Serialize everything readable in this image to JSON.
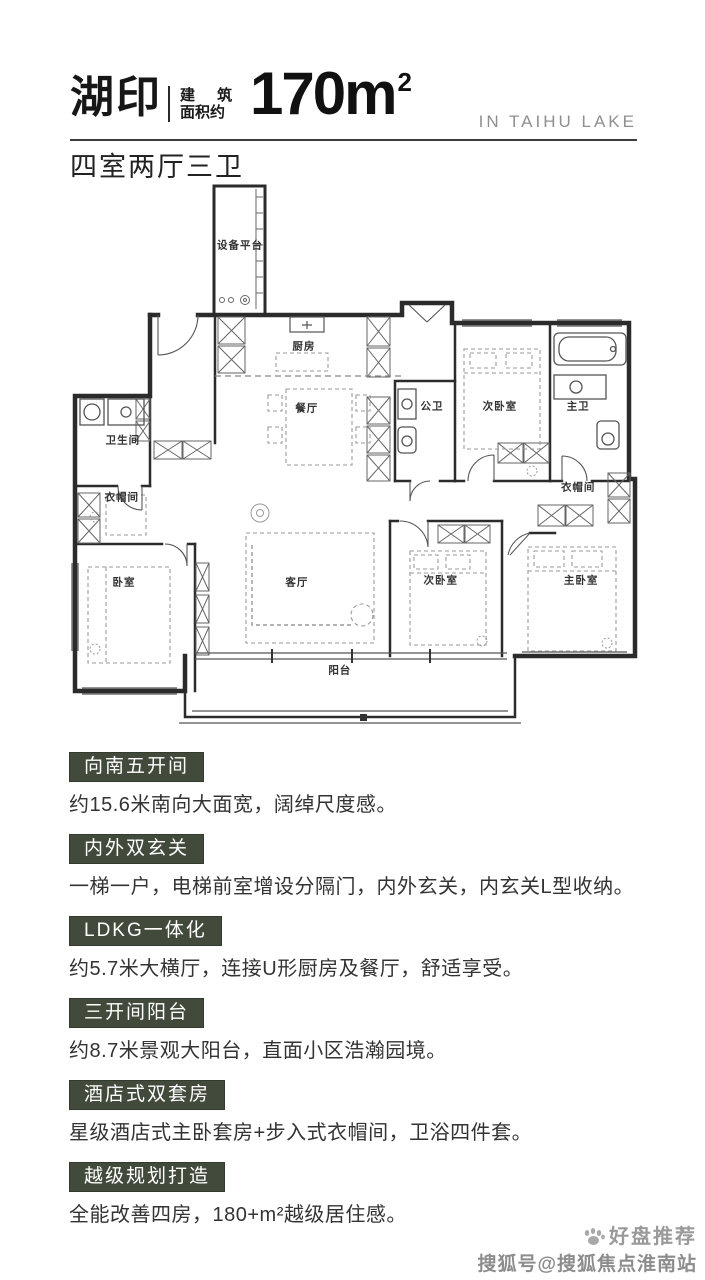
{
  "header": {
    "project_name": "湖印",
    "area_prefix_line1": "建 筑",
    "area_prefix_line2": "面积约",
    "area_value": "170m",
    "area_superscript": "2",
    "tagline_en": "IN TAIHU LAKE",
    "layout_summary": "四室两厅三卫"
  },
  "floor_plan": {
    "rooms": [
      {
        "name": "设备平台"
      },
      {
        "name": "厨房"
      },
      {
        "name": "餐厅"
      },
      {
        "name": "公卫"
      },
      {
        "name": "次卧室"
      },
      {
        "name": "主卫"
      },
      {
        "name": "卫生间"
      },
      {
        "name": "衣帽间"
      },
      {
        "name": "卧室"
      },
      {
        "name": "客厅"
      },
      {
        "name": "次卧室"
      },
      {
        "name": "主卧室"
      },
      {
        "name": "衣帽间"
      },
      {
        "name": "阳台"
      }
    ]
  },
  "features": [
    {
      "title": "向南五开间",
      "description": "约15.6米南向大面宽，阔绰尺度感。"
    },
    {
      "title": "内外双玄关",
      "description": "一梯一户，电梯前室增设分隔门，内外玄关，内玄关L型收纳。"
    },
    {
      "title": "LDKG一体化",
      "description": "约5.7米大横厅，连接U形厨房及餐厅，舒适享受。"
    },
    {
      "title": "三开间阳台",
      "description": "约8.7米景观大阳台，直面小区浩瀚园境。"
    },
    {
      "title": "酒店式双套房",
      "description": "星级酒店式主卧套房+步入式衣帽间，卫浴四件套。"
    },
    {
      "title": "越级规划打造",
      "description": "全能改善四房，180+m²越级居住感。"
    }
  ],
  "watermark": {
    "line1": "好盘推荐",
    "line2": "搜狐号@搜狐焦点淮南站"
  },
  "colors": {
    "badge_green": "#424a3b",
    "header_text": "#171717",
    "tagline_gray": "#8f8f8f",
    "divider": "#3c3c3c",
    "watermark_gray": "#8c8c8c"
  }
}
